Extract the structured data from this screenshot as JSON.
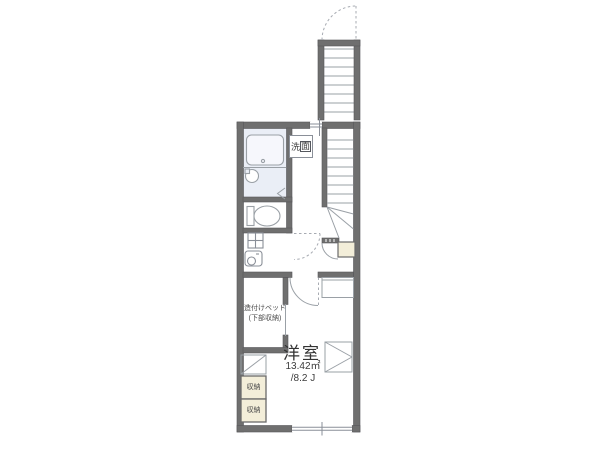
{
  "floor_plan": {
    "type": "apartment-floor-plan",
    "labels": {
      "laundry_char1": "洗",
      "laundry_char2": "面",
      "bed_line1": "造付けベッド",
      "bed_line2": "(下部収納)",
      "room_name": "洋室",
      "room_area_m2": "13.42㎡",
      "room_area_jo": "/8.2 J",
      "storage_upper": "収納",
      "storage_lower": "収納"
    },
    "symbols": [
      "exterior-staircase-icon",
      "interior-staircase-icon",
      "door-swing-arc-icon",
      "bathtub-icon",
      "washbasin-icon",
      "toilet-icon",
      "washing-machine-pan-icon",
      "window-icon",
      "built-in-shelf-icon"
    ],
    "colors": {
      "wall": "#6f6f6f",
      "bath_fill": "#eaeef6",
      "storage_fill": "#f3eed9",
      "line": "#9aa0a6",
      "text": "#3c3c3c",
      "background": "#ffffff"
    }
  }
}
